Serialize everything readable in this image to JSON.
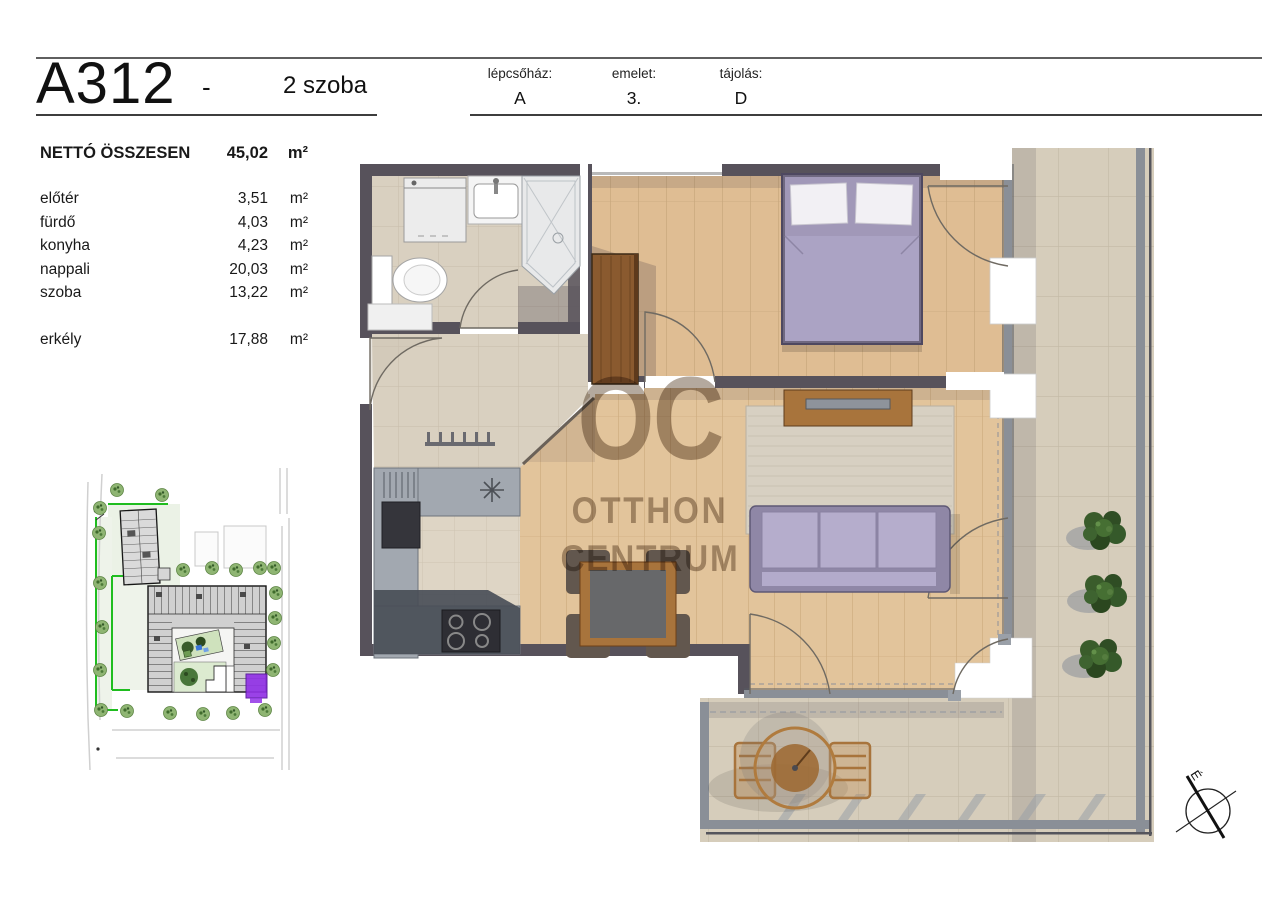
{
  "sheet": {
    "unit_code": "A312",
    "separator": "-",
    "unit_type": "2 szoba"
  },
  "header_fields": [
    {
      "label": "lépcsőház:",
      "value": "A"
    },
    {
      "label": "emelet:",
      "value": "3."
    },
    {
      "label": "tájolás:",
      "value": "D"
    }
  ],
  "area_table": {
    "total": {
      "name": "NETTÓ ÖSSZESEN",
      "value": "45,02",
      "unit": "m²"
    },
    "rooms": [
      {
        "name": "előtér",
        "value": "3,51",
        "unit": "m²"
      },
      {
        "name": "fürdő",
        "value": "4,03",
        "unit": "m²"
      },
      {
        "name": "konyha",
        "value": "4,23",
        "unit": "m²"
      },
      {
        "name": "nappali",
        "value": "20,03",
        "unit": "m²"
      },
      {
        "name": "szoba",
        "value": "13,22",
        "unit": "m²"
      }
    ],
    "outdoor": [
      {
        "name": "erkély",
        "value": "17,88",
        "unit": "m²"
      }
    ]
  },
  "watermark": {
    "line1": "OC",
    "line2": "OTTHON",
    "line3": "CENTRUM"
  },
  "compass": {
    "north_label": "É"
  },
  "colors": {
    "accent_purple": "#9232e6",
    "boundary_green": "#1fbd1f",
    "watermark_brown": "#6f5a44",
    "wood_floor": "#e2c49b",
    "bedroom_floor": "#dfbd93",
    "tile_floor": "#d9d0c0",
    "balcony_tile": "#d6cdbb",
    "wall_dark": "#57525b",
    "sofa_lavender": "#b3abcb",
    "bed_lavender": "#aba3c4",
    "counter_gray": "#a2a8b0",
    "rail_gray": "#8a8f97",
    "plant_green": "#3a5c2b",
    "furniture_wood": "#a8743c"
  }
}
